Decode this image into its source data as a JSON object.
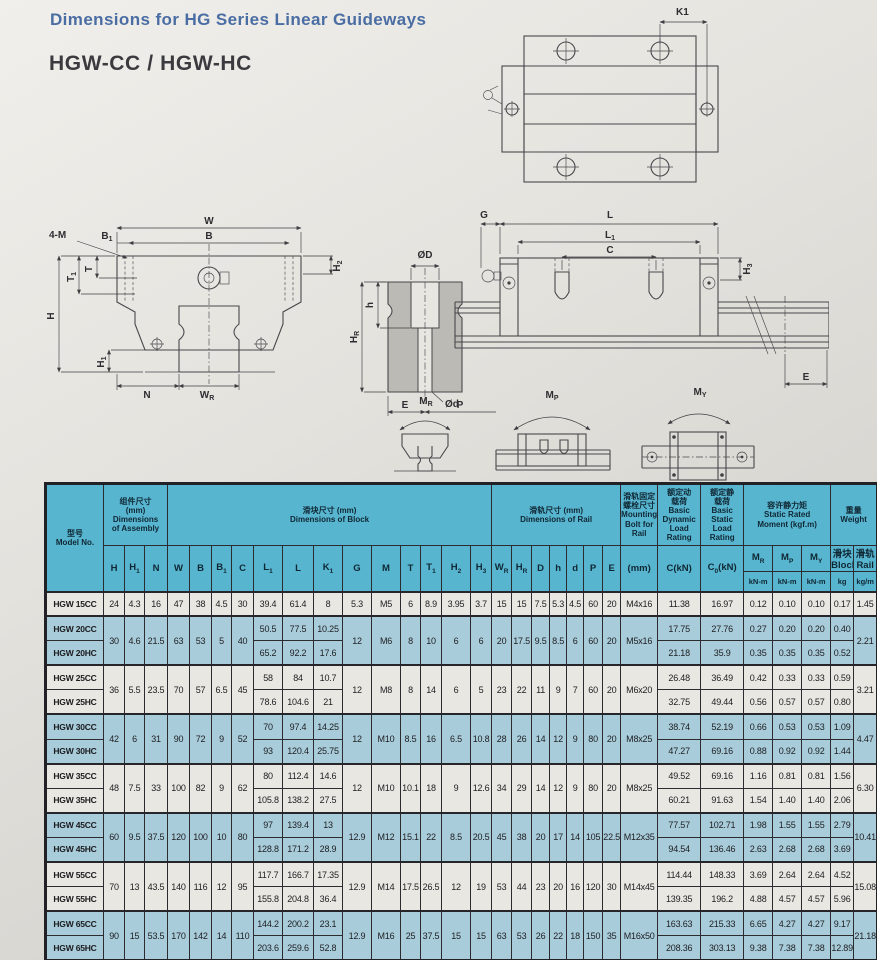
{
  "page": {
    "title": "Dimensions for HG Series Linear Guideways",
    "model_series": "HGW-CC / HGW-HC"
  },
  "colors": {
    "title_blue": "#4a6da3",
    "header_blue": "#58b5d0",
    "row_blue": "#a8ccda",
    "row_plain": "#e9e7e1"
  },
  "diagrams": {
    "labels": {
      "k1": "K1",
      "w": "W",
      "b": "B",
      "b1b": "B",
      "b1s": "1",
      "m4": "4-M",
      "t": "T",
      "t1b": "T",
      "t1s": "1",
      "h": "H",
      "h2b": "H",
      "h2s": "2",
      "h1b": "H",
      "h1s": "1",
      "n": "N",
      "wrb": "W",
      "wrs": "R",
      "od": "ØD",
      "hole_h": "h",
      "hrb": "H",
      "hrs": "R",
      "od2": "Ød",
      "e": "E",
      "p": "P",
      "g": "G",
      "l": "L",
      "l1b": "L",
      "l1s": "1",
      "c": "C",
      "h3b": "H",
      "h3s": "3",
      "e2": "E",
      "mrb": "M",
      "mrs": "R",
      "mpb": "M",
      "mps": "P",
      "myb": "M",
      "mys": "Y"
    }
  },
  "table": {
    "header": [
      [
        {
          "n": "col-model",
          "rs": 3,
          "lines": [
            [
              "型号"
            ],
            [
              "Model No."
            ]
          ]
        },
        {
          "n": "group-assembly",
          "cs": 3,
          "lines": [
            [
              "组件尺寸"
            ],
            [
              "(mm)"
            ],
            [
              "Dimensions"
            ],
            [
              "of Assembly"
            ]
          ]
        },
        {
          "n": "group-block",
          "cs": 13,
          "lines": [
            [
              "滑块尺寸 (mm)"
            ],
            [
              "Dimensions of Block"
            ]
          ]
        },
        {
          "n": "group-rail",
          "cs": 7,
          "lines": [
            [
              "滑轨尺寸 (mm)"
            ],
            [
              "Dimensions of Rail"
            ]
          ]
        },
        {
          "n": "group-bolt",
          "lines": [
            [
              "滑轨固定"
            ],
            [
              "螺栓尺寸"
            ],
            [
              "Mounting"
            ],
            [
              "Bolt for"
            ],
            [
              "Rail"
            ]
          ]
        },
        {
          "n": "group-dynamic-load",
          "lines": [
            [
              "额定动"
            ],
            [
              "载荷"
            ],
            [
              "Basic"
            ],
            [
              "Dynamic"
            ],
            [
              "Load"
            ],
            [
              "Rating"
            ]
          ]
        },
        {
          "n": "group-static-load",
          "lines": [
            [
              "额定静"
            ],
            [
              "载荷"
            ],
            [
              "Basic"
            ],
            [
              "Static"
            ],
            [
              "Load"
            ],
            [
              "Rating"
            ]
          ]
        },
        {
          "n": "group-static-moment",
          "cs": 3,
          "lines": [
            [
              "容许静力矩"
            ],
            [
              "Static Rated"
            ],
            [
              "Moment (kgf.m)"
            ]
          ]
        },
        {
          "n": "group-weight",
          "cs": 2,
          "lines": [
            [
              "重量"
            ],
            [
              "Weight"
            ]
          ]
        }
      ],
      [
        {
          "n": "col-h",
          "rs": 2,
          "lines": [
            [
              "H"
            ]
          ]
        },
        {
          "n": "col-h1",
          "rs": 2,
          "lines": [
            [
              "H",
              {
                "s": "1"
              }
            ]
          ]
        },
        {
          "n": "col-n",
          "rs": 2,
          "lines": [
            [
              "N"
            ]
          ]
        },
        {
          "n": "col-w",
          "rs": 2,
          "lines": [
            [
              "W"
            ]
          ]
        },
        {
          "n": "col-b",
          "rs": 2,
          "lines": [
            [
              "B"
            ]
          ]
        },
        {
          "n": "col-b1",
          "rs": 2,
          "lines": [
            [
              "B",
              {
                "s": "1"
              }
            ]
          ]
        },
        {
          "n": "col-c",
          "rs": 2,
          "lines": [
            [
              "C"
            ]
          ]
        },
        {
          "n": "col-l1",
          "rs": 2,
          "lines": [
            [
              "L",
              {
                "s": "1"
              }
            ]
          ]
        },
        {
          "n": "col-l",
          "rs": 2,
          "lines": [
            [
              "L"
            ]
          ]
        },
        {
          "n": "col-k1",
          "rs": 2,
          "lines": [
            [
              "K",
              {
                "s": "1"
              }
            ]
          ]
        },
        {
          "n": "col-g",
          "rs": 2,
          "lines": [
            [
              "G"
            ]
          ]
        },
        {
          "n": "col-m",
          "rs": 2,
          "lines": [
            [
              "M"
            ]
          ]
        },
        {
          "n": "col-t",
          "rs": 2,
          "lines": [
            [
              "T"
            ]
          ]
        },
        {
          "n": "col-t1",
          "rs": 2,
          "lines": [
            [
              "T",
              {
                "s": "1"
              }
            ]
          ]
        },
        {
          "n": "col-h2",
          "rs": 2,
          "lines": [
            [
              "H",
              {
                "s": "2"
              }
            ]
          ]
        },
        {
          "n": "col-h3",
          "rs": 2,
          "lines": [
            [
              "H",
              {
                "s": "3"
              }
            ]
          ]
        },
        {
          "n": "col-wr",
          "rs": 2,
          "lines": [
            [
              "W",
              {
                "s": "R"
              }
            ]
          ]
        },
        {
          "n": "col-hr",
          "rs": 2,
          "lines": [
            [
              "H",
              {
                "s": "R"
              }
            ]
          ]
        },
        {
          "n": "col-d",
          "rs": 2,
          "lines": [
            [
              "D"
            ]
          ]
        },
        {
          "n": "col-hh",
          "rs": 2,
          "lines": [
            [
              "h"
            ]
          ]
        },
        {
          "n": "col-dd",
          "rs": 2,
          "lines": [
            [
              "d"
            ]
          ]
        },
        {
          "n": "col-p",
          "rs": 2,
          "lines": [
            [
              "P"
            ]
          ]
        },
        {
          "n": "col-e",
          "rs": 2,
          "lines": [
            [
              "E"
            ]
          ]
        },
        {
          "n": "col-bolt",
          "rs": 2,
          "lines": [
            [
              "(mm)"
            ]
          ]
        },
        {
          "n": "col-ckn",
          "rs": 2,
          "lines": [
            [
              "C(kN)"
            ]
          ]
        },
        {
          "n": "col-c0kn",
          "rs": 2,
          "lines": [
            [
              "C",
              {
                "s": "0"
              },
              "(kN)"
            ]
          ]
        },
        {
          "n": "col-mr",
          "lines": [
            [
              "M",
              {
                "s": "R"
              }
            ]
          ]
        },
        {
          "n": "col-mp",
          "lines": [
            [
              "M",
              {
                "s": "P"
              }
            ]
          ]
        },
        {
          "n": "col-my",
          "lines": [
            [
              "M",
              {
                "s": "Y"
              }
            ]
          ]
        },
        {
          "n": "col-wblock",
          "lines": [
            [
              "滑块"
            ],
            [
              "Block"
            ]
          ]
        },
        {
          "n": "col-wrail",
          "lines": [
            [
              "滑轨"
            ],
            [
              "Rail"
            ]
          ]
        }
      ],
      [
        {
          "n": "unit-mr",
          "lines": [
            [
              "kN-m"
            ]
          ]
        },
        {
          "n": "unit-mp",
          "lines": [
            [
              "kN-m"
            ]
          ]
        },
        {
          "n": "unit-my",
          "lines": [
            [
              "kN-m"
            ]
          ]
        },
        {
          "n": "unit-block-kg",
          "lines": [
            [
              "kg"
            ]
          ]
        },
        {
          "n": "unit-rail-kgm",
          "lines": [
            [
              "kg/m"
            ]
          ]
        }
      ]
    ],
    "groups": [
      {
        "models": [
          "HGW 15CC"
        ],
        "shaded": false,
        "merged_a": [
          "24",
          "4.3",
          "16",
          "47",
          "38",
          "4.5",
          "30"
        ],
        "per_llk": [
          [
            "39.4",
            "61.4",
            "8"
          ]
        ],
        "merged_b": [
          "5.3",
          "M5",
          "6",
          "8.9",
          "3.95",
          "3.7",
          "15",
          "15",
          "7.5",
          "5.3",
          "4.5",
          "60",
          "20",
          "M4x16"
        ],
        "per_loads": [
          [
            "11.38",
            "16.97",
            "0.12",
            "0.10",
            "0.10",
            "0.17"
          ]
        ],
        "rail_kg": "1.45"
      },
      {
        "models": [
          "HGW 20CC",
          "HGW 20HC"
        ],
        "shaded": true,
        "merged_a": [
          "30",
          "4.6",
          "21.5",
          "63",
          "53",
          "5",
          "40"
        ],
        "per_llk": [
          [
            "50.5",
            "77.5",
            "10.25"
          ],
          [
            "65.2",
            "92.2",
            "17.6"
          ]
        ],
        "merged_b": [
          "12",
          "M6",
          "8",
          "10",
          "6",
          "6",
          "20",
          "17.5",
          "9.5",
          "8.5",
          "6",
          "60",
          "20",
          "M5x16"
        ],
        "per_loads": [
          [
            "17.75",
            "27.76",
            "0.27",
            "0.20",
            "0.20",
            "0.40"
          ],
          [
            "21.18",
            "35.9",
            "0.35",
            "0.35",
            "0.35",
            "0.52"
          ]
        ],
        "rail_kg": "2.21"
      },
      {
        "models": [
          "HGW 25CC",
          "HGW 25HC"
        ],
        "shaded": false,
        "merged_a": [
          "36",
          "5.5",
          "23.5",
          "70",
          "57",
          "6.5",
          "45"
        ],
        "per_llk": [
          [
            "58",
            "84",
            "10.7"
          ],
          [
            "78.6",
            "104.6",
            "21"
          ]
        ],
        "merged_b": [
          "12",
          "M8",
          "8",
          "14",
          "6",
          "5",
          "23",
          "22",
          "11",
          "9",
          "7",
          "60",
          "20",
          "M6x20"
        ],
        "per_loads": [
          [
            "26.48",
            "36.49",
            "0.42",
            "0.33",
            "0.33",
            "0.59"
          ],
          [
            "32.75",
            "49.44",
            "0.56",
            "0.57",
            "0.57",
            "0.80"
          ]
        ],
        "rail_kg": "3.21"
      },
      {
        "models": [
          "HGW 30CC",
          "HGW 30HC"
        ],
        "shaded": true,
        "merged_a": [
          "42",
          "6",
          "31",
          "90",
          "72",
          "9",
          "52"
        ],
        "per_llk": [
          [
            "70",
            "97.4",
            "14.25"
          ],
          [
            "93",
            "120.4",
            "25.75"
          ]
        ],
        "merged_b": [
          "12",
          "M10",
          "8.5",
          "16",
          "6.5",
          "10.8",
          "28",
          "26",
          "14",
          "12",
          "9",
          "80",
          "20",
          "M8x25"
        ],
        "per_loads": [
          [
            "38.74",
            "52.19",
            "0.66",
            "0.53",
            "0.53",
            "1.09"
          ],
          [
            "47.27",
            "69.16",
            "0.88",
            "0.92",
            "0.92",
            "1.44"
          ]
        ],
        "rail_kg": "4.47"
      },
      {
        "models": [
          "HGW 35CC",
          "HGW 35HC"
        ],
        "shaded": false,
        "merged_a": [
          "48",
          "7.5",
          "33",
          "100",
          "82",
          "9",
          "62"
        ],
        "per_llk": [
          [
            "80",
            "112.4",
            "14.6"
          ],
          [
            "105.8",
            "138.2",
            "27.5"
          ]
        ],
        "merged_b": [
          "12",
          "M10",
          "10.1",
          "18",
          "9",
          "12.6",
          "34",
          "29",
          "14",
          "12",
          "9",
          "80",
          "20",
          "M8x25"
        ],
        "per_loads": [
          [
            "49.52",
            "69.16",
            "1.16",
            "0.81",
            "0.81",
            "1.56"
          ],
          [
            "60.21",
            "91.63",
            "1.54",
            "1.40",
            "1.40",
            "2.06"
          ]
        ],
        "rail_kg": "6.30"
      },
      {
        "models": [
          "HGW 45CC",
          "HGW 45HC"
        ],
        "shaded": true,
        "merged_a": [
          "60",
          "9.5",
          "37.5",
          "120",
          "100",
          "10",
          "80"
        ],
        "per_llk": [
          [
            "97",
            "139.4",
            "13"
          ],
          [
            "128.8",
            "171.2",
            "28.9"
          ]
        ],
        "merged_b": [
          "12.9",
          "M12",
          "15.1",
          "22",
          "8.5",
          "20.5",
          "45",
          "38",
          "20",
          "17",
          "14",
          "105",
          "22.5",
          "M12x35"
        ],
        "per_loads": [
          [
            "77.57",
            "102.71",
            "1.98",
            "1.55",
            "1.55",
            "2.79"
          ],
          [
            "94.54",
            "136.46",
            "2.63",
            "2.68",
            "2.68",
            "3.69"
          ]
        ],
        "rail_kg": "10.41"
      },
      {
        "models": [
          "HGW 55CC",
          "HGW 55HC"
        ],
        "shaded": false,
        "merged_a": [
          "70",
          "13",
          "43.5",
          "140",
          "116",
          "12",
          "95"
        ],
        "per_llk": [
          [
            "117.7",
            "166.7",
            "17.35"
          ],
          [
            "155.8",
            "204.8",
            "36.4"
          ]
        ],
        "merged_b": [
          "12.9",
          "M14",
          "17.5",
          "26.5",
          "12",
          "19",
          "53",
          "44",
          "23",
          "20",
          "16",
          "120",
          "30",
          "M14x45"
        ],
        "per_loads": [
          [
            "114.44",
            "148.33",
            "3.69",
            "2.64",
            "2.64",
            "4.52"
          ],
          [
            "139.35",
            "196.2",
            "4.88",
            "4.57",
            "4.57",
            "5.96"
          ]
        ],
        "rail_kg": "15.08"
      },
      {
        "models": [
          "HGW 65CC",
          "HGW 65HC"
        ],
        "shaded": true,
        "merged_a": [
          "90",
          "15",
          "53.5",
          "170",
          "142",
          "14",
          "110"
        ],
        "per_llk": [
          [
            "144.2",
            "200.2",
            "23.1"
          ],
          [
            "203.6",
            "259.6",
            "52.8"
          ]
        ],
        "merged_b": [
          "12.9",
          "M16",
          "25",
          "37.5",
          "15",
          "15",
          "63",
          "53",
          "26",
          "22",
          "18",
          "150",
          "35",
          "M16x50"
        ],
        "per_loads": [
          [
            "163.63",
            "215.33",
            "6.65",
            "4.27",
            "4.27",
            "9.17"
          ],
          [
            "208.36",
            "303.13",
            "9.38",
            "7.38",
            "7.38",
            "12.89"
          ]
        ],
        "rail_kg": "21.18"
      }
    ]
  }
}
